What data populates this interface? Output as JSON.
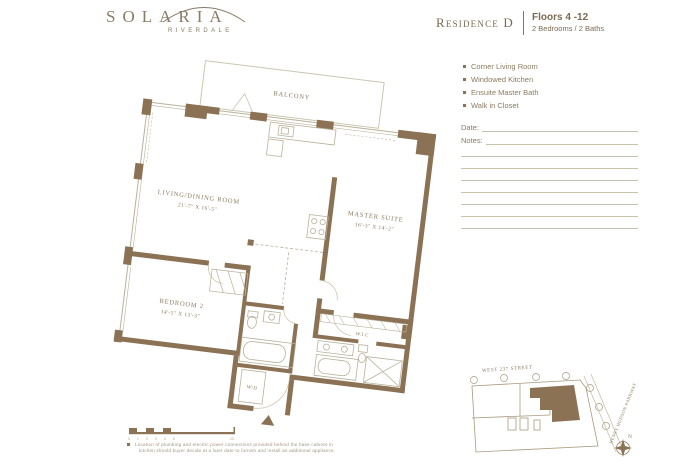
{
  "colors": {
    "wall": "#8c7254",
    "thin_line": "#b9b19a",
    "light_line": "#ccc6b0",
    "text_brown": "#8d7b61"
  },
  "logo": {
    "brand": "SOLARIA",
    "sub_brand": "RIVERDALE"
  },
  "header": {
    "residence_label": "Residence D",
    "floors_label": "Floors 4 -12",
    "bed_bath_label": "2 Bedrooms / 2 Baths"
  },
  "features": [
    "Corner Living Room",
    "Windowed Kitchen",
    "Ensuite Master Bath",
    "Walk in Closet"
  ],
  "note_form": {
    "date_label": "Date:",
    "notes_label": "Notes:"
  },
  "floorplan": {
    "balcony_label": "BALCONY",
    "living": {
      "name": "LIVING/DINING ROOM",
      "dims": "21'-7\" X 16'-5\""
    },
    "master": {
      "name": "MASTER SUITE",
      "dims": "16'-3\" X 14'-2\""
    },
    "bedroom2": {
      "name": "BEDROOM 2",
      "dims": "14'-5\" X 13'-3\""
    },
    "wic_label": "W.I.C",
    "wd_label": "W/D"
  },
  "scalebar": {
    "ticks": [
      "0",
      "1",
      "2",
      "3",
      "4",
      "5",
      "10"
    ]
  },
  "disclaimer": {
    "line1": "Location of plumbing and electric power connections provided behind the base cabinet in",
    "line2": "kitchen should buyer decide at a later date to furnish and install an additional appliance."
  },
  "keyplan": {
    "street_top": "WEST 237 STREET",
    "street_side": "HENRY HUDSON PARKWAY",
    "compass_label": "N"
  }
}
